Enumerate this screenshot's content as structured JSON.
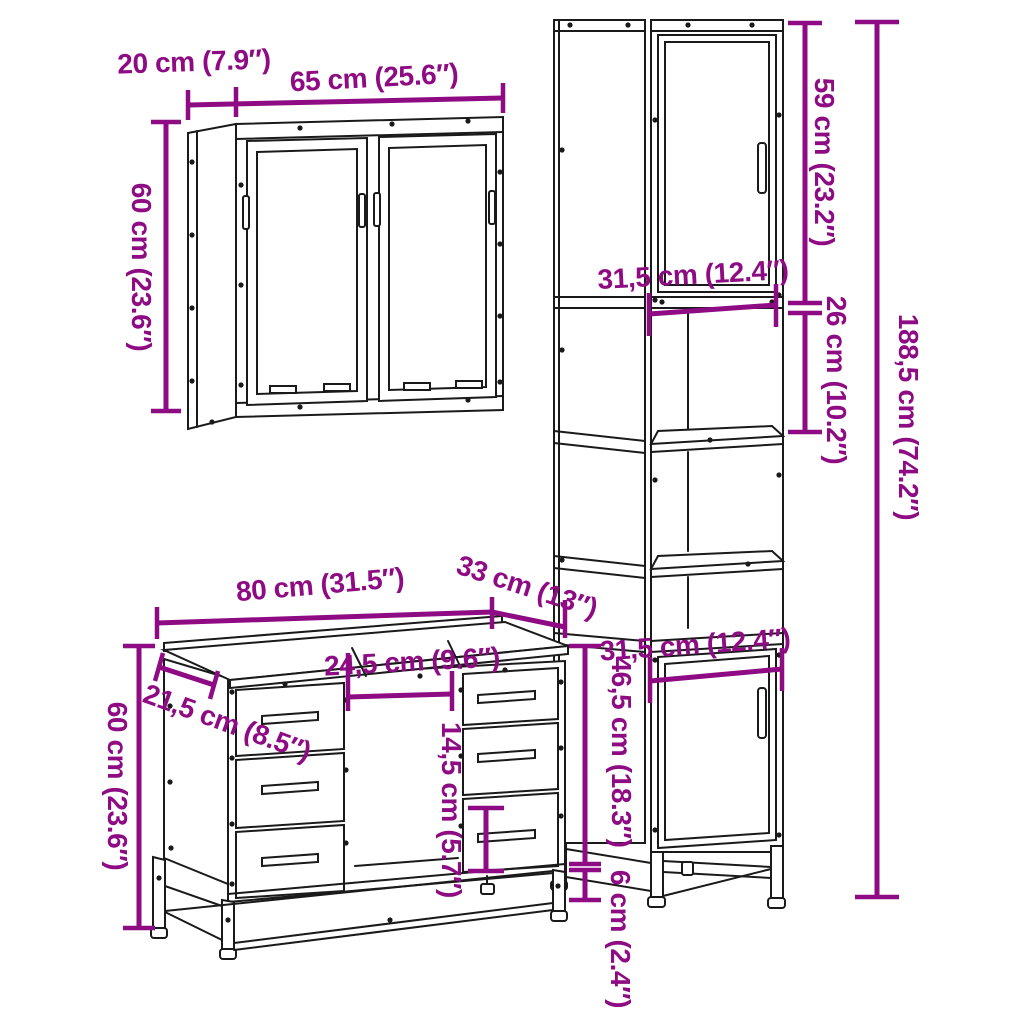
{
  "diagram": {
    "description": "3-piece bathroom furniture set dimension line drawing",
    "accent_color": "#8e0b84",
    "line_color": "#1a1a1a",
    "background_color": "#ffffff",
    "pieces": {
      "wall_cabinet": {
        "name": "wall cabinet with two doors",
        "depth_label": "20 cm (7.9″)",
        "width_label": "65 cm (25.6″)",
        "height_label": "60 cm (23.6″)"
      },
      "tall_cabinet": {
        "name": "tall storage cabinet",
        "top_section_height_label": "59 cm (23.2″)",
        "inner_width_label": "31,5 cm (12.4″)",
        "shelf_gap_label": "26 cm (10.2″)",
        "total_height_label": "188,5 cm (74.2″)",
        "door_width_label": "31,5 cm (12.4″)",
        "bottom_section_height_label": "46,5 cm (18.3″)",
        "leg_height_label": "6 cm (2.4″)"
      },
      "vanity_cabinet": {
        "name": "sink vanity cabinet with drawers",
        "width_label": "80 cm (31.5″)",
        "depth_label": "33 cm (13″)",
        "height_label": "60 cm (23.6″)",
        "side_top_depth_label": "21,5 cm (8.5″)",
        "middle_opening_width_label": "24,5 cm (9.6″)",
        "drawer_front_height_label": "14,5 cm (5.7″)"
      }
    }
  }
}
